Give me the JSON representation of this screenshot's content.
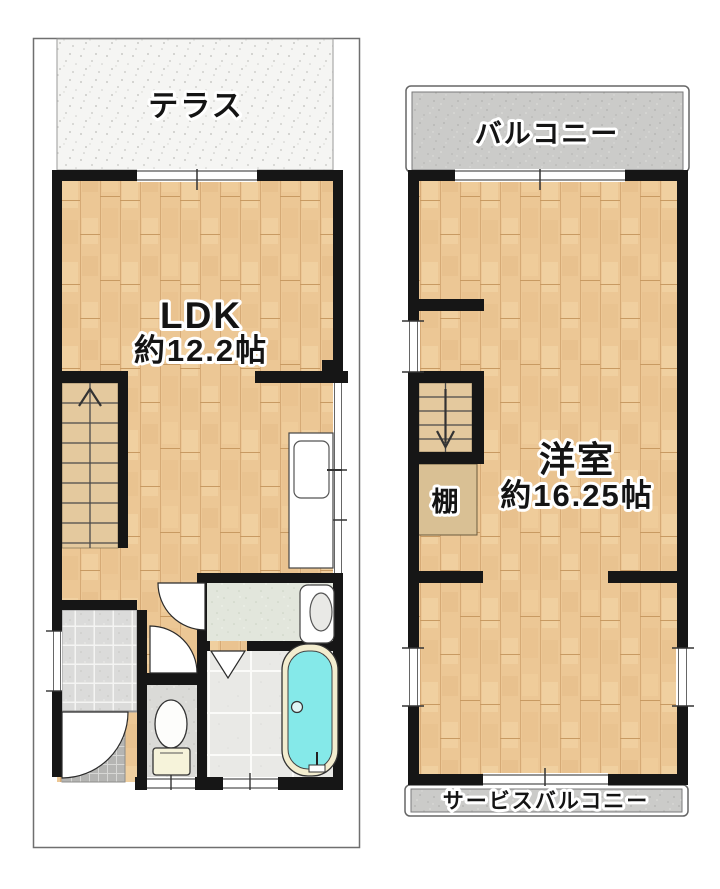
{
  "floor1": {
    "terrace_label": "テラス",
    "ldk_label": "LDK",
    "ldk_size": "約12.2帖"
  },
  "floor2": {
    "balcony_label": "バルコニー",
    "room_label": "洋室",
    "room_size": "約16.25帖",
    "shelf_label": "棚",
    "service_balcony_label": "サービスバルコニー"
  },
  "icons": {
    "stairs_first_floor_arrow": "up-arrow",
    "stairs_second_floor_arrow": "down-arrow"
  },
  "colors": {
    "wall": "#161616",
    "wood_floor": "#ecc795",
    "stair_fill": "#e4c99e",
    "shelf_fill": "#d9c094",
    "terrace_bg": "#f5f5f3",
    "balcony_bg": "#cbcbc9",
    "bath_water": "#85e9e9",
    "tub_rim": "#f3edcf",
    "entrance_tile": "#dbdbda",
    "porch_tile": "#b5b5b3"
  }
}
